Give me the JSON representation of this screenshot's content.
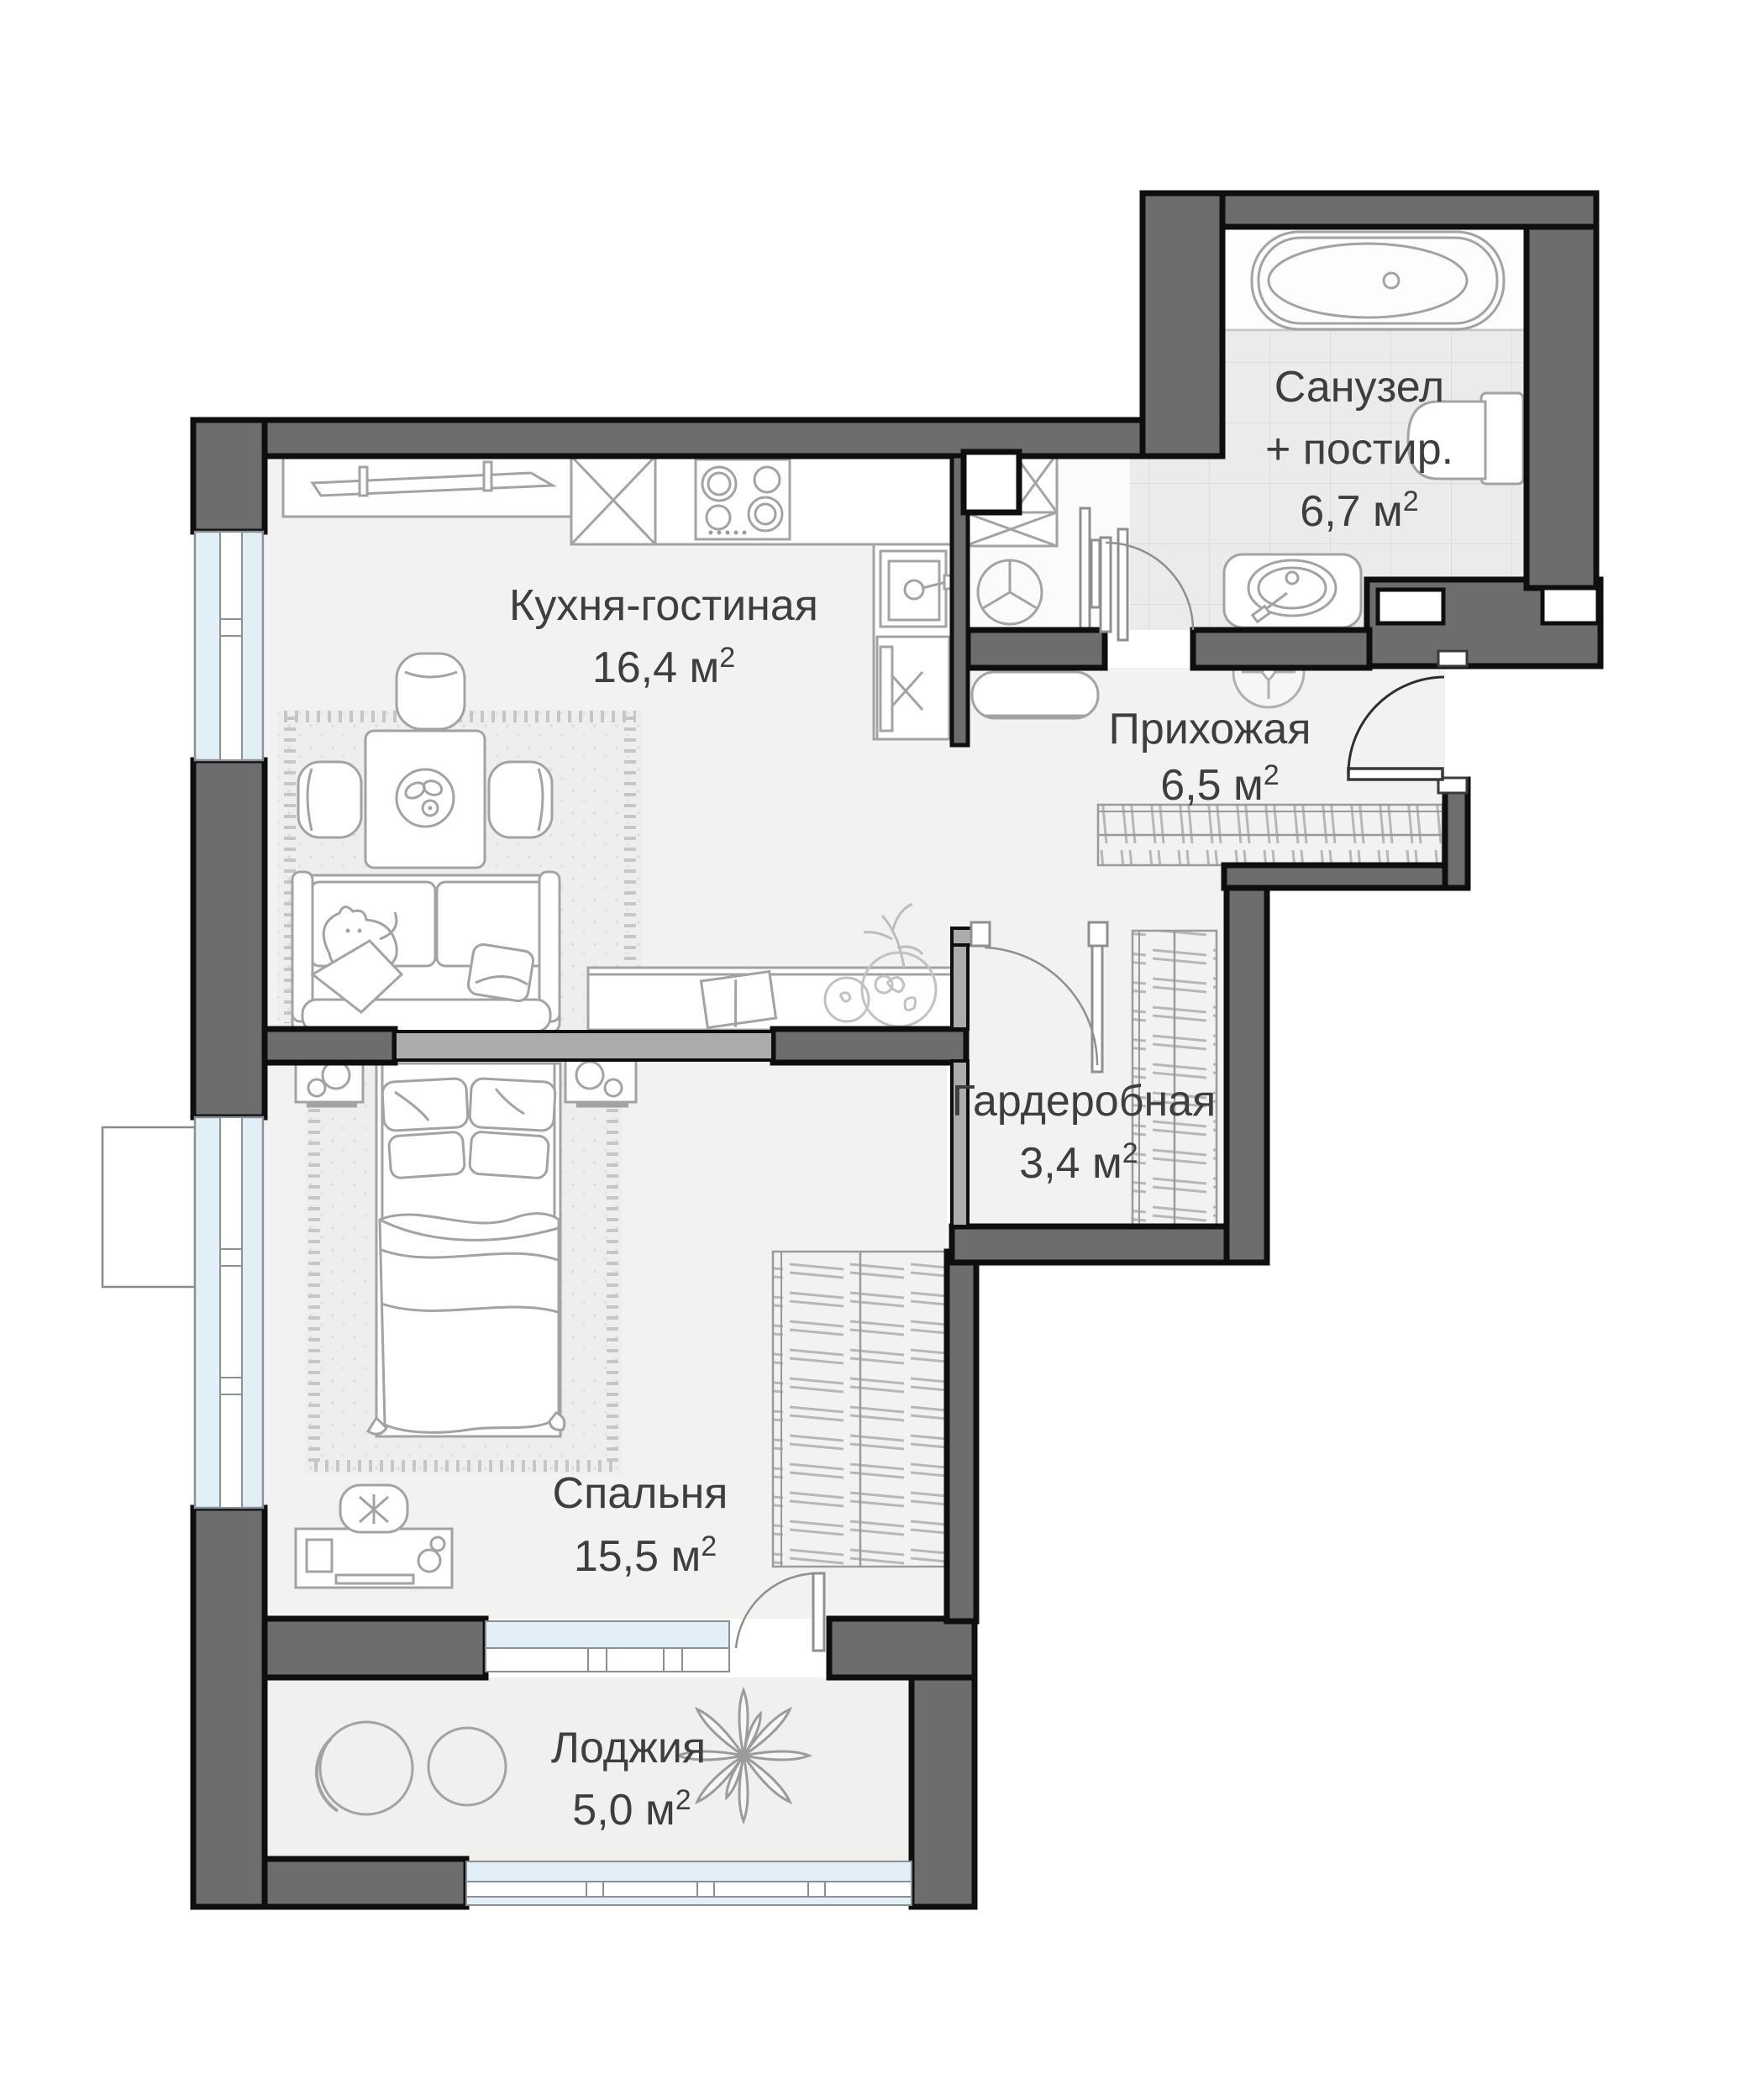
{
  "title": "Apartment floor plan",
  "unit_sup": "2",
  "rooms": {
    "kitchen_living": {
      "name": "Кухня-гостиная",
      "area": "16,4 м"
    },
    "bathroom": {
      "name_line1": "Санузел",
      "name_line2": "+ постир.",
      "area": "6,7 м"
    },
    "hallway": {
      "name": "Прихожая",
      "area": "6,5 м"
    },
    "wardrobe": {
      "name": "Гардеробная",
      "area": "3,4 м"
    },
    "bedroom": {
      "name": "Спальня",
      "area": "15,5 м"
    },
    "loggia": {
      "name": "Лоджия",
      "area": "5,0 м"
    }
  },
  "colors": {
    "wall_dark": "#6d6d6d",
    "wall_light": "#acacac",
    "outline": "#0e0e0e",
    "floor": "#f2f2f1",
    "tile": "#ebebea",
    "glass": "#e3eff7",
    "furniture_stroke": "#a3a3a3",
    "label": "#3e3e3e"
  }
}
